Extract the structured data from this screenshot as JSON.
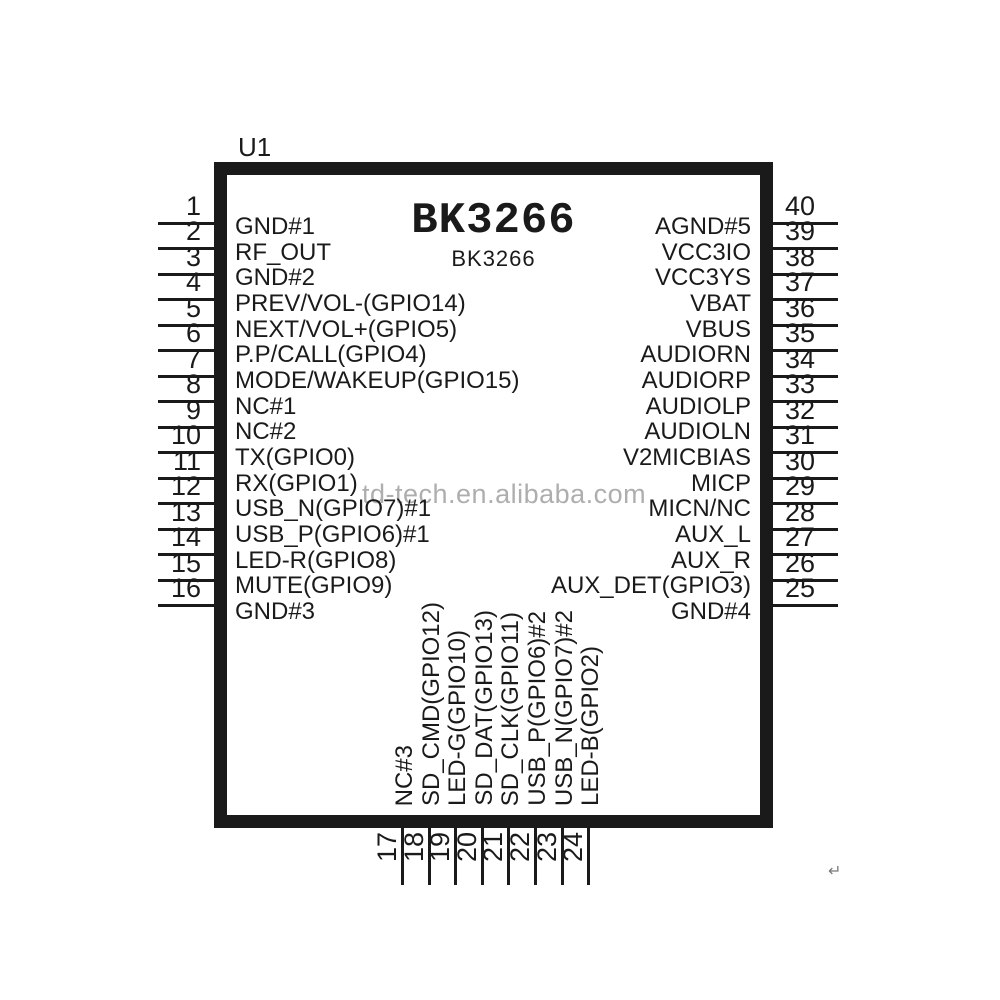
{
  "chip": {
    "refdes": "U1",
    "title": "BK3266",
    "subtitle": "BK3266"
  },
  "watermark": {
    "text": "td-tech.en.alibaba.com"
  },
  "corner_mark": "↵",
  "colors": {
    "ink": "#1a1a1a",
    "watermark_gray": "#a6a6a6",
    "background": "#ffffff"
  },
  "pins": {
    "left": [
      {
        "num": "1",
        "label": "GND#1"
      },
      {
        "num": "2",
        "label": "RF_OUT"
      },
      {
        "num": "3",
        "label": "GND#2"
      },
      {
        "num": "4",
        "label": "PREV/VOL-(GPIO14)"
      },
      {
        "num": "5",
        "label": "NEXT/VOL+(GPIO5)"
      },
      {
        "num": "6",
        "label": "P.P/CALL(GPIO4)"
      },
      {
        "num": "7",
        "label": "MODE/WAKEUP(GPIO15)"
      },
      {
        "num": "8",
        "label": "NC#1"
      },
      {
        "num": "9",
        "label": "NC#2"
      },
      {
        "num": "10",
        "label": "TX(GPIO0)"
      },
      {
        "num": "11",
        "label": "RX(GPIO1)"
      },
      {
        "num": "12",
        "label": "USB_N(GPIO7)#1"
      },
      {
        "num": "13",
        "label": "USB_P(GPIO6)#1"
      },
      {
        "num": "14",
        "label": "LED-R(GPIO8)"
      },
      {
        "num": "15",
        "label": "MUTE(GPIO9)"
      },
      {
        "num": "16",
        "label": "GND#3"
      }
    ],
    "right": [
      {
        "num": "40",
        "label": "AGND#5"
      },
      {
        "num": "39",
        "label": "VCC3IO"
      },
      {
        "num": "38",
        "label": "VCC3YS"
      },
      {
        "num": "37",
        "label": "VBAT"
      },
      {
        "num": "36",
        "label": "VBUS"
      },
      {
        "num": "35",
        "label": "AUDIORN"
      },
      {
        "num": "34",
        "label": "AUDIORP"
      },
      {
        "num": "33",
        "label": "AUDIOLP"
      },
      {
        "num": "32",
        "label": "AUDIOLN"
      },
      {
        "num": "31",
        "label": "V2MICBIAS"
      },
      {
        "num": "30",
        "label": "MICP"
      },
      {
        "num": "29",
        "label": "MICN/NC"
      },
      {
        "num": "28",
        "label": "AUX_L"
      },
      {
        "num": "27",
        "label": "AUX_R"
      },
      {
        "num": "26",
        "label": "AUX_DET(GPIO3)"
      },
      {
        "num": "25",
        "label": "GND#4"
      }
    ],
    "bottom": [
      {
        "num": "17",
        "label": "NC#3"
      },
      {
        "num": "18",
        "label": "SD_CMD(GPIO12)"
      },
      {
        "num": "19",
        "label": "LED-G(GPIO10)"
      },
      {
        "num": "20",
        "label": "SD_DAT(GPIO13)"
      },
      {
        "num": "21",
        "label": "SD_CLK(GPIO11)"
      },
      {
        "num": "22",
        "label": "USB_P(GPIO6)#2"
      },
      {
        "num": "23",
        "label": "USB_N(GPIO7)#2"
      },
      {
        "num": "24",
        "label": "LED-B(GPIO2)"
      }
    ]
  }
}
